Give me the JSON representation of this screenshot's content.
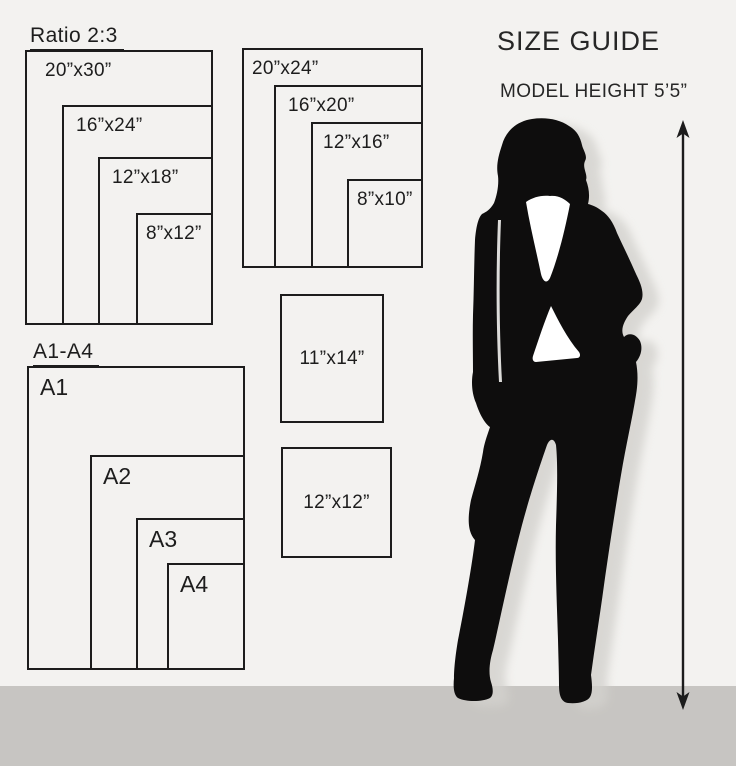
{
  "header": {
    "title": "SIZE GUIDE",
    "model_height": "MODEL HEIGHT 5’5”"
  },
  "ratio_group": {
    "label": "Ratio 2:3",
    "sizes": [
      "20”x30”",
      "16”x24”",
      "12”x18”",
      "8”x12”"
    ]
  },
  "standard_group": {
    "sizes": [
      "20”x24”",
      "16”x20”",
      "12”x16”",
      "8”x10”"
    ]
  },
  "single_frames": [
    {
      "size": "11”x14”"
    },
    {
      "size": "12”x12”"
    }
  ],
  "a_series_group": {
    "label": "A1-A4",
    "sizes": [
      "A1",
      "A2",
      "A3",
      "A4"
    ]
  },
  "icons": {
    "silhouette": "woman-model-silhouette",
    "arrow": "height-measure-arrow"
  },
  "colors": {
    "background": "#f3f2f0",
    "floor": "#c7c5c2",
    "line": "#1c1c1c",
    "silhouette": "#0e0d0d",
    "shadow": "#d3d1cd",
    "shirt": "#ffffff"
  }
}
